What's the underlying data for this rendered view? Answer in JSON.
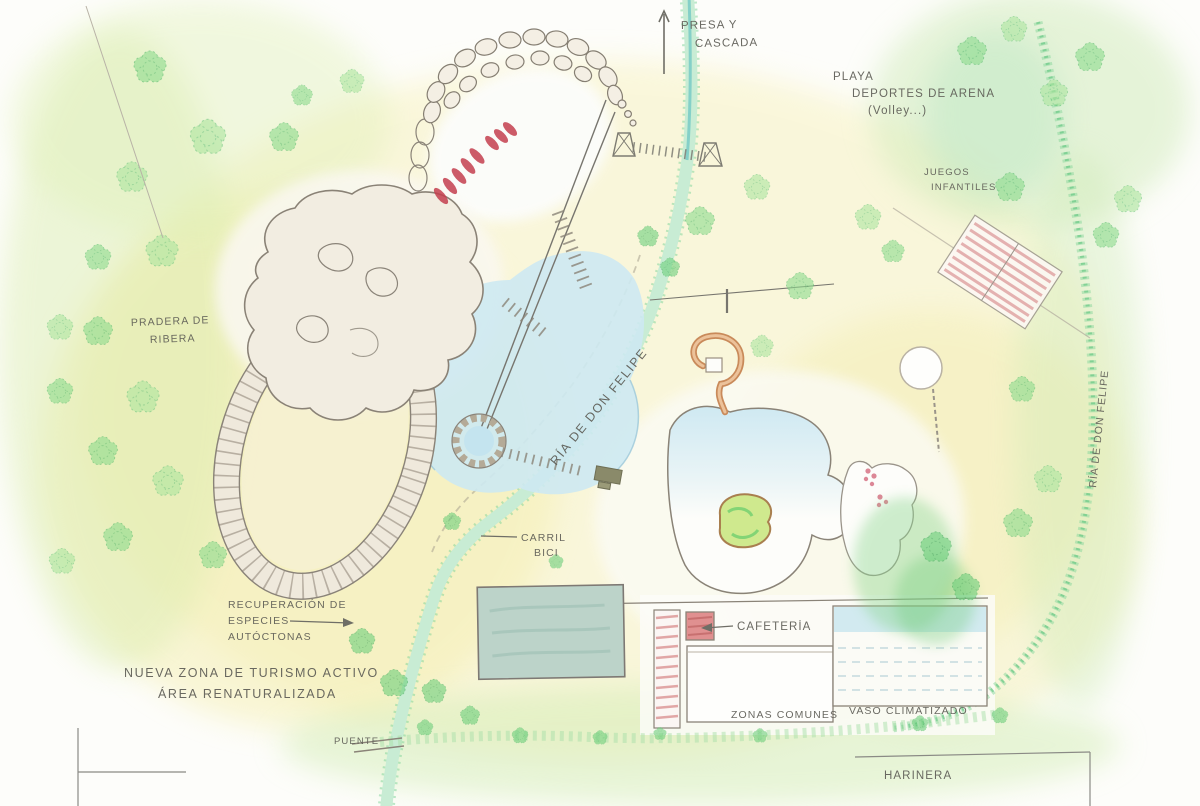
{
  "title": "Plano boceto de parque fluvial",
  "colors": {
    "ink": "#5e5d56",
    "pencil": "#8a8378",
    "wash_yellow": "#f6f0b6",
    "wash_green": "#d8edaf",
    "river_green": "#8fd9a0",
    "water_blue": "#cde9f2",
    "kayak_red": "#c4404f",
    "building_hatch_red": "#d98c8c",
    "tree_green": "#6fd07d",
    "slide_brown": "#c98a5a"
  },
  "labels": {
    "presa": {
      "lines": [
        "PRESA Y",
        "CASCADA"
      ]
    },
    "playa": {
      "lines": [
        "PLAYA",
        "DEPORTES DE ARENA",
        "(Volley...)"
      ]
    },
    "juegos": {
      "lines": [
        "JUEGOS",
        "INFANTILES"
      ]
    },
    "pradera": {
      "lines": [
        "PRADERA DE",
        "RIBERA"
      ]
    },
    "ria_center": "RÍA DE DON FELIPE",
    "ria_right": "RÍA DE DON FELIPE",
    "carril": {
      "lines": [
        "CARRIL",
        "BICI"
      ]
    },
    "recuperacion": {
      "lines": [
        "RECUPERACIÓN DE",
        "ESPECIES",
        "AUTÓCTONAS"
      ]
    },
    "nueva_zona": {
      "lines": [
        "NUEVA ZONA DE TURISMO ACTIVO",
        "ÁREA RENATURALIZADA"
      ]
    },
    "puente": "PUENTE",
    "cafeteria": "CAFETERÍA",
    "zonas_comunes": "ZONAS COMUNES",
    "vaso": "VASO CLIMATIZADO",
    "harinera": "HARINERA"
  }
}
